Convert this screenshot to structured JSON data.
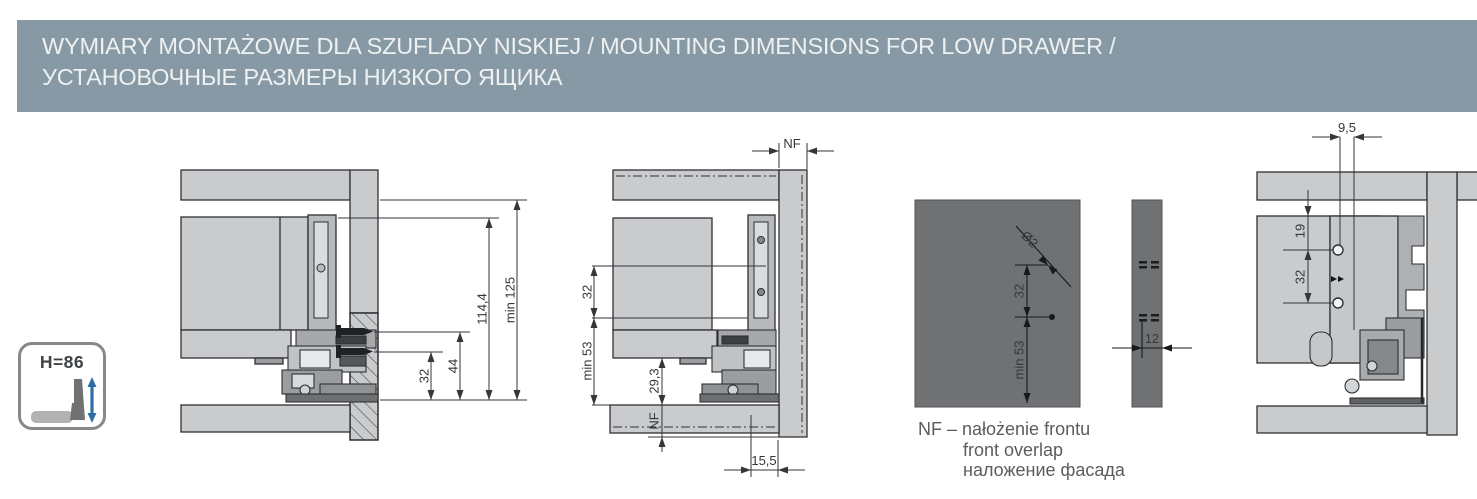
{
  "header": {
    "title_line1": "WYMIARY MONTAŻOWE DLA SZUFLADY NISKIEJ / MOUNTING DIMENSIONS FOR LOW DRAWER /",
    "title_line2": "УСТАНОВОЧНЫЕ РАЗМЕРЫ НИЗКОГО ЯЩИКА"
  },
  "dims": {
    "a": {
      "min125": "min 125",
      "d114": "114,4",
      "d44": "44",
      "d32": "32"
    },
    "b": {
      "nf_top": "NF",
      "d32": "32",
      "min53": "min 53",
      "d293": "29,3",
      "nf_bottom": "NF",
      "d155": "15,5"
    },
    "c": {
      "dia": "Ø2",
      "d32": "32",
      "min53": "min 53",
      "d12": "12"
    },
    "d": {
      "d95": "9,5",
      "d19": "19",
      "d32": "32"
    }
  },
  "legend": {
    "line1": "NF – nałożenie frontu",
    "line2": "front overlap",
    "line3": "наложение фасада"
  },
  "badge": {
    "label": "H=86"
  },
  "colors": {
    "header_bg": "#8799A4",
    "panel_light": "#C9CBCD",
    "panel_dark": "#6F7173",
    "outline": "#2E3134",
    "dimension": "#33363A",
    "accent_blue": "#2E6DA8"
  }
}
